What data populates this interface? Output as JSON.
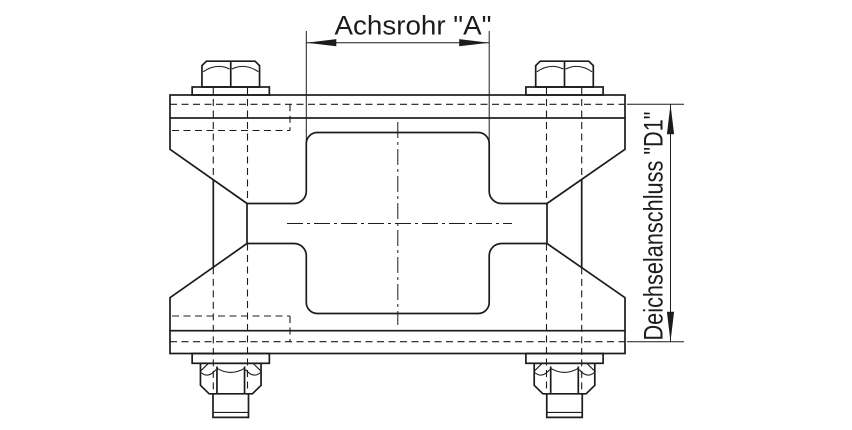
{
  "canvas": {
    "background": "#ffffff",
    "line_color": "#1c1c1c"
  },
  "labels": {
    "axle_tube_dimension": "Achsrohr \"A\"",
    "drawbar_connection_dimension": "Deichselanschluss \"D1\""
  }
}
